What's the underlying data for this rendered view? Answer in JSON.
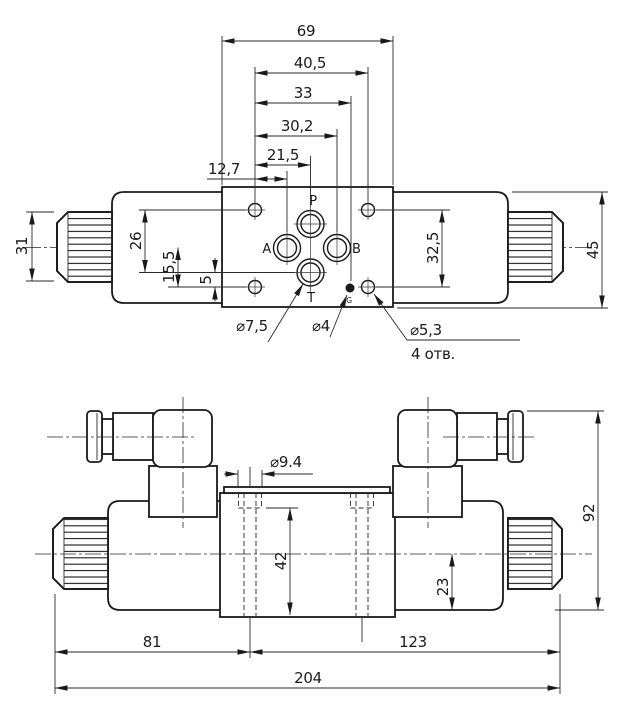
{
  "top_view": {
    "ports": {
      "p": "P",
      "a": "A",
      "b": "B",
      "t": "T",
      "g": "G"
    },
    "dims": {
      "total_width": "69",
      "holes_x": "40,5",
      "gauge_x": "33",
      "port_b_x": "30,2",
      "port_pt_x": "21,5",
      "port_a_x": "12,7",
      "knob_height": "31",
      "holes_to_t": "26",
      "ab_to_holes": "15,5",
      "t_to_holes": "5",
      "holes_y_spacing": "32,5",
      "solenoid_height": "45"
    },
    "callouts": {
      "t_port": "⌀7,5",
      "gauge_port": "⌀4",
      "mount_hole": "⌀5,3",
      "mount_qty": "4 отв."
    }
  },
  "front_view": {
    "dims": {
      "counterbore": "⌀9.4",
      "bore_depth": "42",
      "center_to_base": "23",
      "total_height": "92",
      "left_section": "81",
      "right_section": "123",
      "total_width": "204"
    }
  }
}
